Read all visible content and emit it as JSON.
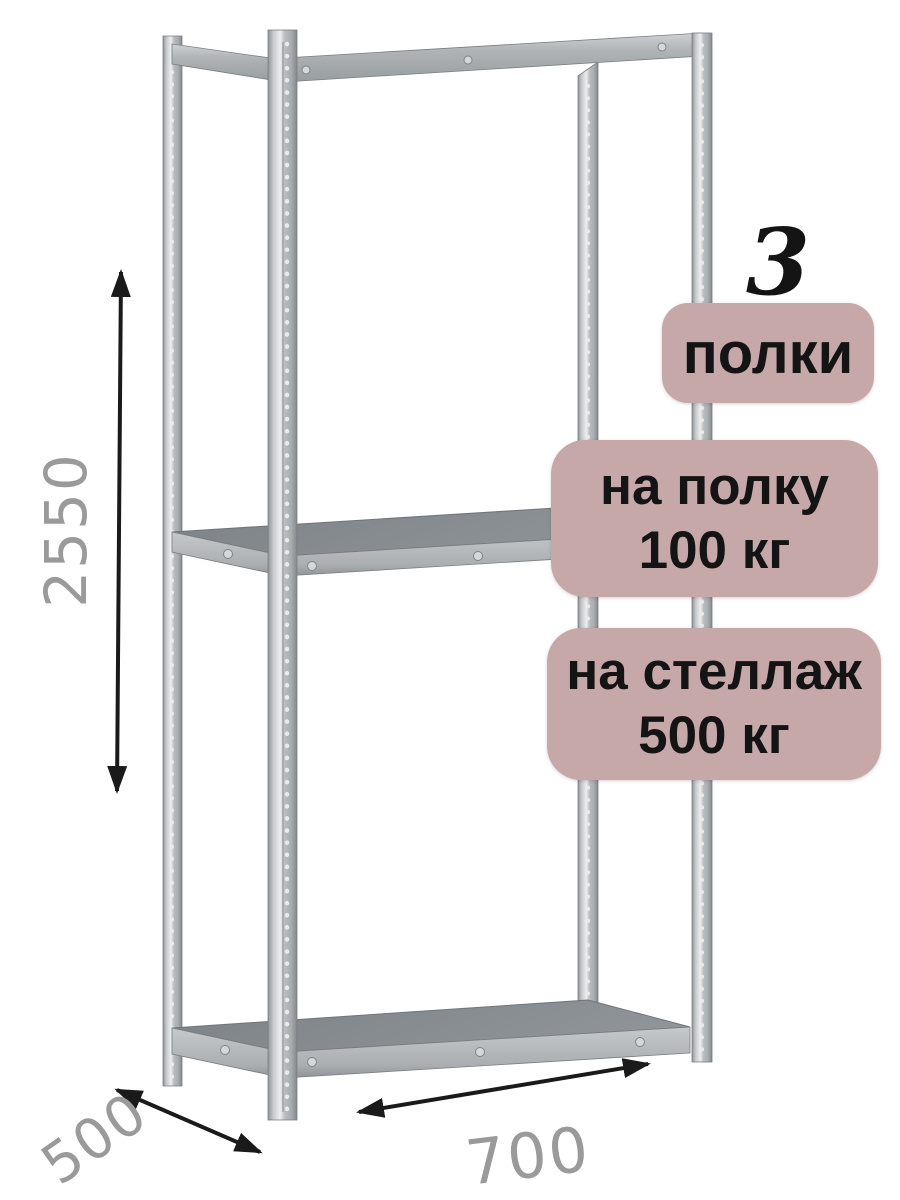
{
  "illustration": {
    "description": "metal boltless shelving rack, isometric view, 3 shelves"
  },
  "dimension_labels": {
    "height": "2550",
    "depth": "500",
    "width": "700"
  },
  "badges": {
    "count_number": "3",
    "count_label": "полки",
    "shelf_load_line1": "на полку",
    "shelf_load_line2": "100 кг",
    "rack_load_line1": "на стеллаж",
    "rack_load_line2": "500 кг"
  },
  "colors": {
    "background": "#ffffff",
    "badge_background": "#c6a8a9",
    "badge_text": "#141414",
    "dimension_text": "#9a9a9a",
    "arrow": "#1a1a1a",
    "metal_light": "#c9ccce",
    "metal_mid": "#a9adb0",
    "metal_dark": "#83888c"
  }
}
